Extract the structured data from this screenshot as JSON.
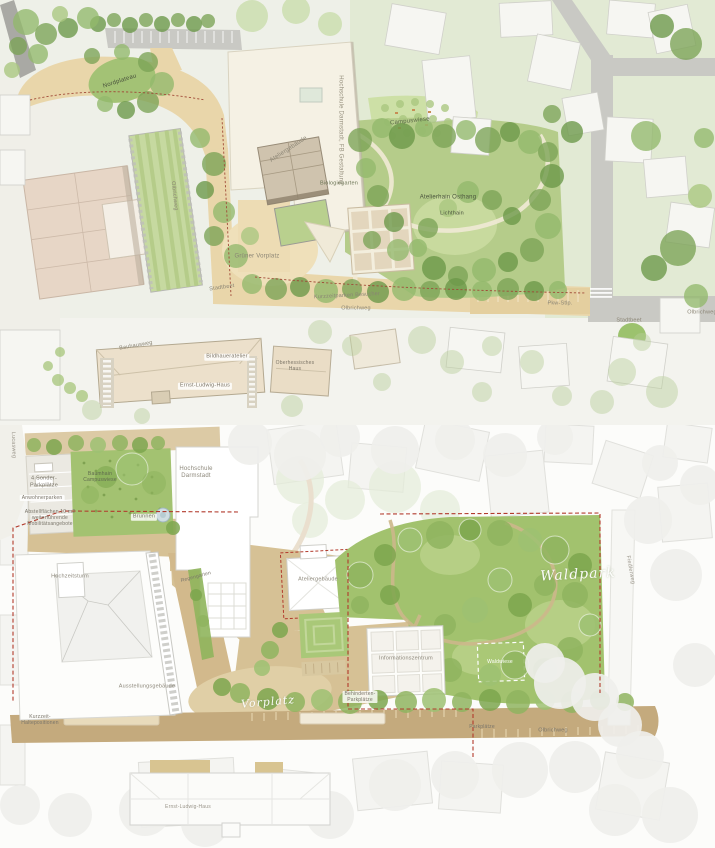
{
  "top_plan": {
    "labels": {
      "nordplateau": "Nordplateau",
      "hochschule_gebaeude": "Hochschule Darmstadt, FB Gestaltung",
      "campuswiese": "Campuswiese",
      "ateliergebaeude": "Ateliergebäude",
      "biologiegarten": "Biologiegarten",
      "atelierhain_osthang": "Atelierhain Osthang",
      "lichthain": "Lichthain",
      "gruener_vorplatz": "Grüner Vorplatz",
      "stadtbeet_west": "Stadtbeet",
      "kurzzeitparken": "Kurzzeitparken Besucher",
      "olbrichweg_mitte": "Olbrichweg",
      "pkw_stellplaetze": "Pkw-Stlp.",
      "stadtbeet_ost": "Stadtbeet",
      "olbrichweg_ost": "Olbrichweg",
      "olbrichweg_nord": "Olbrichweg",
      "bauhausweg": "Bauhausweg",
      "bildhaueratelier": "Bildhaueratelier",
      "ernst_ludwig_haus": "Ernst-Ludwig-Haus",
      "oberhessisches_haus": [
        "Oberhessisches",
        "Haus"
      ]
    }
  },
  "bottom_plan": {
    "labels": {
      "lucasweg": "Lucasweg",
      "sonder_parkplaetze": [
        "4 Sonder-",
        "Parkplätze"
      ],
      "anwohnerparken": "Anwohnerparken",
      "abstellflaechen": [
        "Abstellflächen 10 m2",
        "weiterführende",
        "Mobilitätsangebote"
      ],
      "baumhain": [
        "Baumhain",
        "Campuswiese"
      ],
      "hochschule": [
        "Hochschule",
        "Darmstadt"
      ],
      "brunnen": "Brunnen",
      "regengarten": "Regengarten",
      "hochzeitsturm": "Hochzeitsturm",
      "ausstellungsgebaeude": "Ausstellungsgebäude",
      "ateliergebaeude": "Ateliergebäude",
      "informationszentrum": "Informationszentrum",
      "waldpark": "Waldpark",
      "waldwiese": "Waldwiese",
      "fiedlerweg": "Fiedlerweg",
      "vorplatz": "Vorplatz",
      "kurzzeit_halte": [
        "Kurzzeit-",
        "Haltepositionen"
      ],
      "behinderten_parkplaetze": [
        "Behinderten-",
        "Parkplätze"
      ],
      "olbrichweg": "Olbrichweg",
      "parkplaetze": "Parkplätze",
      "ernst_ludwig_haus": "Ernst-Ludwig-Haus"
    }
  },
  "colors": {
    "sand": "#e9d6aa",
    "sand_light": "#efe0ba",
    "road_gray": "#c9c9c4",
    "bg_green": "#e2ead4",
    "park_green": "#b5cc8a",
    "campus_green": "#cde0a6",
    "building_cream": "#f5f1e4",
    "building_pink": "#e7d6c6",
    "tan_path": "#d6c195",
    "street_tan": "#c4aa7d",
    "waldpark_green": "#a2c26e",
    "block_green": "#a3c271",
    "boundary_red": "#b23a2c"
  }
}
